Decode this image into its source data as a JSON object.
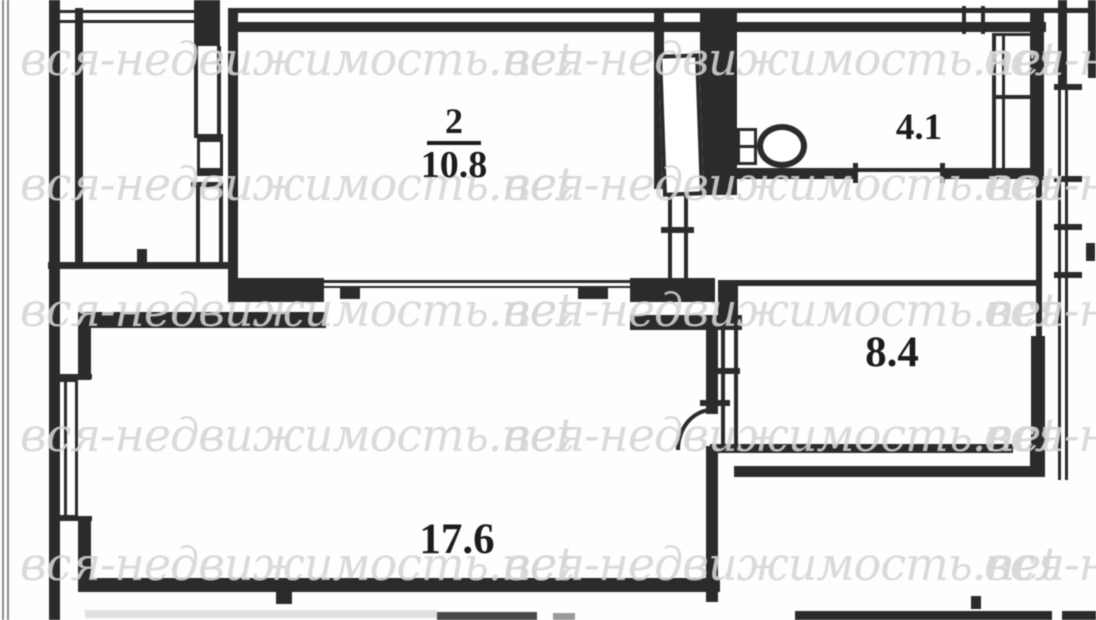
{
  "watermark": {
    "text": "вся-недвижимость.net"
  },
  "rooms": {
    "room2": {
      "number": "2",
      "area": "10.8"
    },
    "bathroom": {
      "area": "4.1"
    },
    "room84": {
      "area": "8.4"
    },
    "living": {
      "area": "17.6"
    }
  },
  "icons": {
    "toilet": "toilet",
    "door_swing": "door-swing-arc"
  },
  "colors": {
    "wall": "#2b2b2b",
    "watermark": "#d5d5d5",
    "label": "#1c1c1c",
    "background": "#fefefe"
  }
}
